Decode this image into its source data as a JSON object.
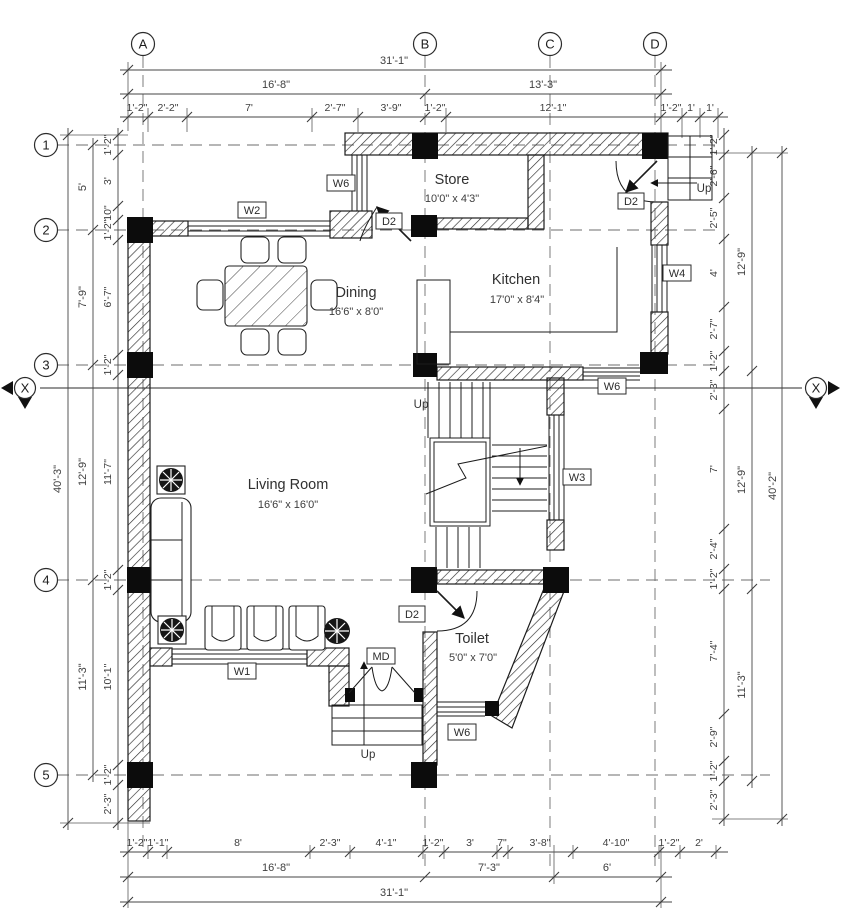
{
  "grid": {
    "cols": [
      "A",
      "B",
      "C",
      "D"
    ],
    "rows": [
      "1",
      "2",
      "3",
      "4",
      "5"
    ],
    "section_marker": "X"
  },
  "rooms": {
    "store": {
      "name": "Store",
      "size": "10'0\" x 4'3\""
    },
    "kitchen": {
      "name": "Kitchen",
      "size": "17'0\" x 8'4\""
    },
    "dining": {
      "name": "Dining",
      "size": "16'6\" x 8'0\""
    },
    "living": {
      "name": "Living Room",
      "size": "16'6\" x 16'0\""
    },
    "toilet": {
      "name": "Toilet",
      "size": "5'0\" x 7'0\""
    }
  },
  "tags": {
    "w1": "W1",
    "w2": "W2",
    "w3": "W3",
    "w4": "W4",
    "w6": "W6",
    "d2": "D2",
    "md": "MD",
    "up": "Up"
  },
  "dims": {
    "top": {
      "total": "31'-1\"",
      "spans": [
        "16'-8\"",
        "13'-3\""
      ],
      "chain": [
        "1'-2\"",
        "2'-2\"",
        "7'",
        "2'-7\"",
        "3'-9\"",
        "1'-2\"",
        "12'-1\"",
        "1'-2\"",
        "1'",
        "1'"
      ]
    },
    "bottom": {
      "total": "31'-1\"",
      "spans": [
        "16'-8\"",
        "7'-3\"",
        "6'"
      ],
      "chain": [
        "1'-2\"",
        "1'-1\"",
        "8'",
        "2'-3\"",
        "4'-1\"",
        "1'-2\"",
        "3'",
        "7\"",
        "3'-8\"",
        "4'-10\"",
        "1'-2\"",
        "2'"
      ]
    },
    "left": {
      "total": "40'-3\"",
      "spans": [
        "5'",
        "7'-9\"",
        "12'-9\"",
        "11'-3\""
      ],
      "chain": [
        "1'-2\"",
        "3'",
        "10\"",
        "1'-2\"",
        "6'-7\"",
        "1'-2\"",
        "11'-7\"",
        "1'-2\"",
        "10'-1\"",
        "1'-2\"",
        "2'-3\""
      ]
    },
    "right": {
      "total": "40'-2\"",
      "spans": [
        "12'-9\"",
        "12'-9\"",
        "11'-3\""
      ],
      "chain": [
        "1'-2\"",
        "2'-6\"",
        "2'-5\"",
        "4'",
        "2'-7\"",
        "1'-2\"",
        "2'-3\"",
        "7'",
        "2'-4\"",
        "1'-2\"",
        "7'-4\"",
        "2'-9\"",
        "1'-2\"",
        "2'-3\""
      ]
    }
  }
}
